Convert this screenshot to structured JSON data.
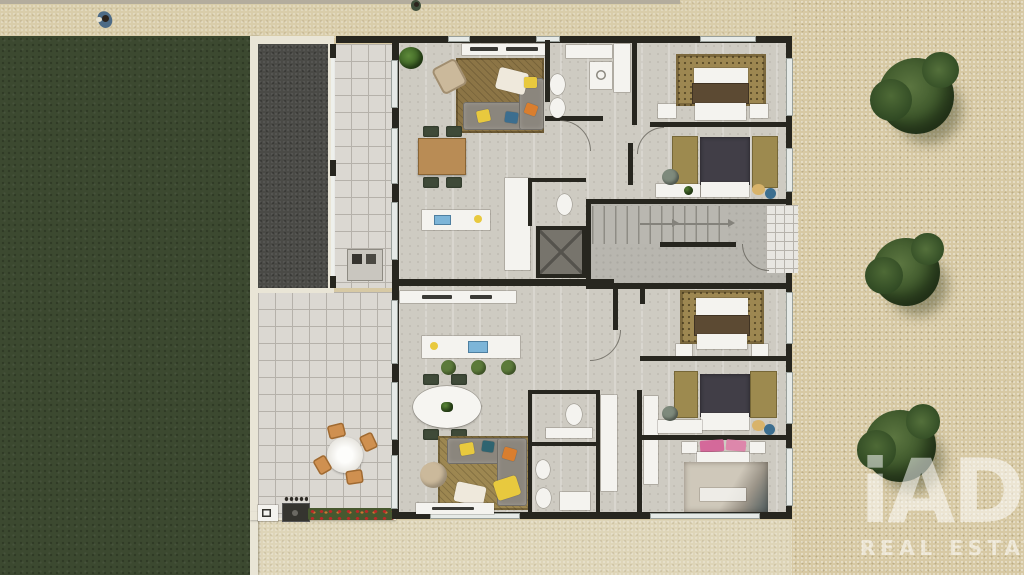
{
  "watermark": {
    "brand": "iAD",
    "tagline": "REAL ESTATE"
  },
  "palette": {
    "sidewalk": "#d9cdaa",
    "gravel": "#d7c9a4",
    "gravelDark": "#4a4a46",
    "lawn": "#3c4930",
    "tileLight": "#dbd8d2",
    "tileLine": "#b5b1aa",
    "floor": "#cecbc2",
    "floorHall": "#b8b6af",
    "wall": "#27261f",
    "white": "#f4f3ef",
    "wood": "#b98c55",
    "rugBrown": "#8c7546",
    "rugTan": "#9d8751",
    "sofa": "#8b867d",
    "duvetBrown": "#5c4a33",
    "duvetCharcoal": "#413e47",
    "olive": "#9d8a4f",
    "chairGreen": "#3f4a38",
    "chairWood": "#cf9050",
    "stoolGreen": "#5c7a3a",
    "pouf": "#cbb99b",
    "pink": "#d4699a",
    "accentYellow": "#e8c93e",
    "accentOrange": "#d97e2e",
    "accentBlue": "#3c6e8f",
    "accentTeal": "#2f6470",
    "sinkBlue": "#7db5d8",
    "elevator": "#77746c"
  },
  "scene": {
    "type": "top-down 3D rendered floor plan",
    "environment": [
      "sidewalk-top",
      "lawn-left",
      "gravel-right",
      "dark-gravel-terrace",
      "tiled-balcony",
      "tiled-patio",
      "flower-bed",
      "barbecue-counter",
      "patio-dining-set",
      "sidewalk-bottom"
    ],
    "trees": 3,
    "pedestrians": 2,
    "building": {
      "core": [
        "staircase",
        "elevator",
        "entrance-landing"
      ],
      "units": [
        {
          "name": "upper-apartment",
          "rooms": [
            "living-room",
            "dining-area",
            "kitchen",
            "bathroom",
            "wc",
            "bedroom-1",
            "bedroom-2"
          ]
        },
        {
          "name": "lower-apartment",
          "rooms": [
            "living-room",
            "dining-area",
            "kitchen",
            "bathroom",
            "shower-room",
            "corridor",
            "bedroom-1",
            "bedroom-2",
            "bedroom-3"
          ]
        }
      ]
    }
  }
}
